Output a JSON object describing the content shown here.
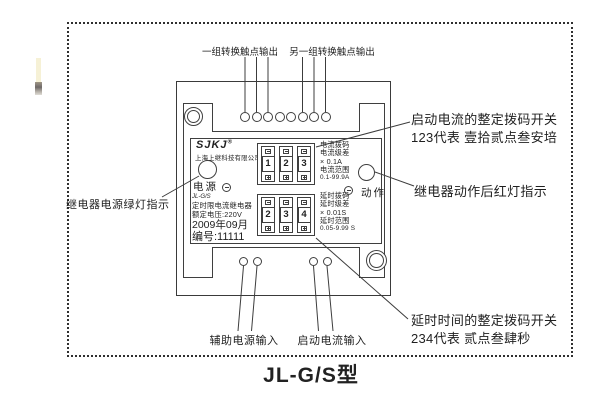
{
  "figure": {
    "title": "JL-G/S型"
  },
  "annotations": {
    "top_left_contacts": "一组转换触点输出",
    "top_right_contacts": "另一组转换触点输出",
    "left_power_led": "继电器电源绿灯指示",
    "right_current_switch_line1": "启动电流的整定拨码开关",
    "right_current_switch_line2": "123代表 壹拾贰点叁安培",
    "right_action_led": "继电器动作后红灯指示",
    "bottom_delay_switch_line1": "延时时间的整定拨码开关",
    "bottom_delay_switch_line2": "234代表 贰点叁肆秒",
    "bottom_aux_power": "辅助电源输入",
    "bottom_start_current": "启动电流输入"
  },
  "device": {
    "brand": {
      "logo": "SJKJ",
      "registered": "®",
      "company": "上海上继科技有限公司"
    },
    "power_label": "电源",
    "action_label": "动作",
    "info": {
      "model": "JL-G/S",
      "type": "定时限电流继电器",
      "rated_voltage": "额定电压:220V",
      "date": "2009年09月",
      "serial": "编号:11111"
    },
    "current_switch": {
      "digits": [
        "1",
        "2",
        "3"
      ],
      "label_lines": [
        "电流拨码",
        "电流级差",
        "× 0.1A",
        "电流范围",
        "0.1-99.9A"
      ]
    },
    "delay_switch": {
      "digits": [
        "2",
        "3",
        "4"
      ],
      "label_lines": [
        "延时拨码",
        "延时级差",
        "× 0.01S",
        "延时范围",
        "0.05-9.99 S"
      ]
    }
  }
}
